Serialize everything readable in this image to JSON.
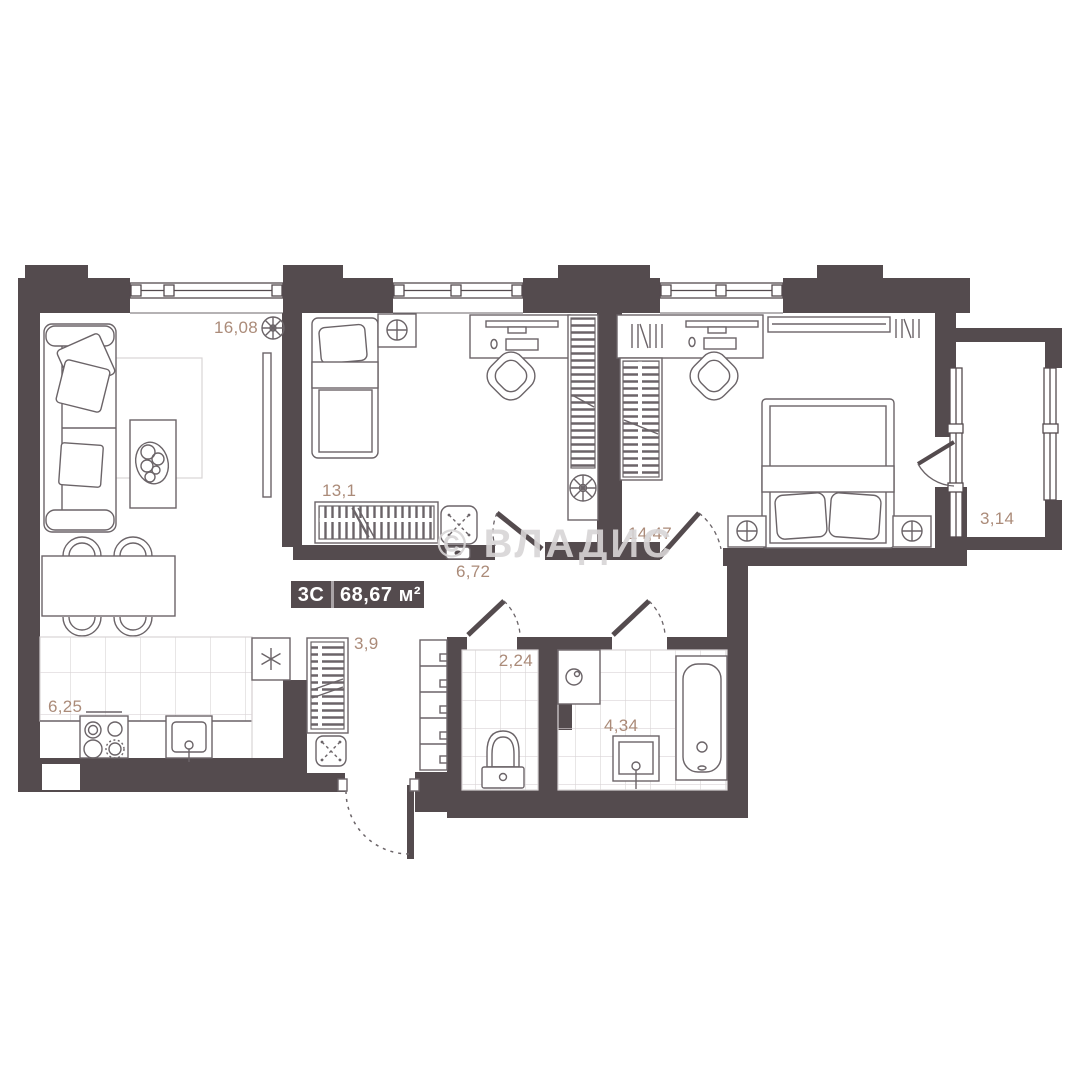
{
  "plan": {
    "plate": {
      "type": "3С",
      "area": "68,67 м²"
    },
    "watermark": "© ВЛАДИС",
    "rooms": [
      {
        "name": "living-room",
        "area": "16,08"
      },
      {
        "name": "bedroom",
        "area": "13,1"
      },
      {
        "name": "corridor",
        "area": "6,72"
      },
      {
        "name": "master-bedroom",
        "area": "14,47"
      },
      {
        "name": "balcony",
        "area": "3,14"
      },
      {
        "name": "kitchen",
        "area": "6,25"
      },
      {
        "name": "hallway",
        "area": "3,9"
      },
      {
        "name": "wc",
        "area": "2,24"
      },
      {
        "name": "bathroom",
        "area": "4,34"
      }
    ],
    "colors": {
      "wall": "#544b4e",
      "furniture": "#6b6468",
      "room_label": "#ab8b79",
      "tile": "#d9d4d6",
      "watermark": "#d8d5d6",
      "plate_text": "#ffffff"
    }
  }
}
